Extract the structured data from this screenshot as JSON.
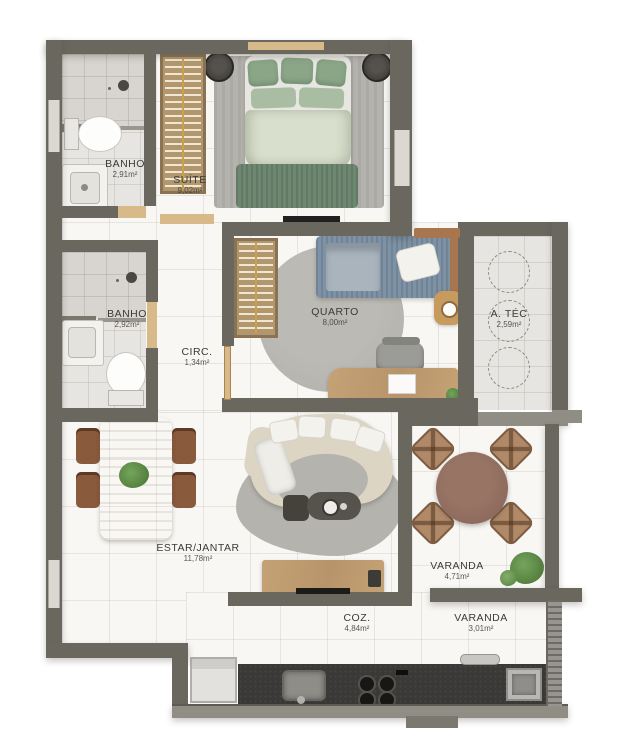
{
  "palette": {
    "wall": "#6a675f",
    "wall_light": "#908d85",
    "floor": "#f8f7f4",
    "bath_floor": "#e7e5e1",
    "wood": "#c5a176",
    "wood_light": "#d8b98a",
    "wood_dark": "#a8764e",
    "rug": "#b5b3ae",
    "bed_green": "#6d8770",
    "pillow_green": "#8aa687",
    "bed_blue": "#7e92a5",
    "sofa": "#ddd5c3",
    "chair_brown": "#8a5a3c",
    "counter": "#3a3937",
    "table_brown": "#8a675a",
    "plant": "#55813f",
    "text": "#3b3a36"
  },
  "rooms": {
    "banho1": {
      "name": "BANHO",
      "area": "2,91m²"
    },
    "suite": {
      "name": "SUÍTE",
      "area": "9,02m²"
    },
    "banho2": {
      "name": "BANHO",
      "area": "2,92m²"
    },
    "circ": {
      "name": "CIRC.",
      "area": "1,34m²"
    },
    "quarto": {
      "name": "QUARTO",
      "area": "8,00m²"
    },
    "atec": {
      "name": "A. TÉC",
      "area": "2,59m²"
    },
    "estar": {
      "name": "ESTAR/JANTAR",
      "area": "11,78m²"
    },
    "varanda1": {
      "name": "VARANDA",
      "area": "4,71m²"
    },
    "coz": {
      "name": "COZ.",
      "area": "4,84m²"
    },
    "varanda2": {
      "name": "VARANDA",
      "area": "3,01m²"
    }
  }
}
